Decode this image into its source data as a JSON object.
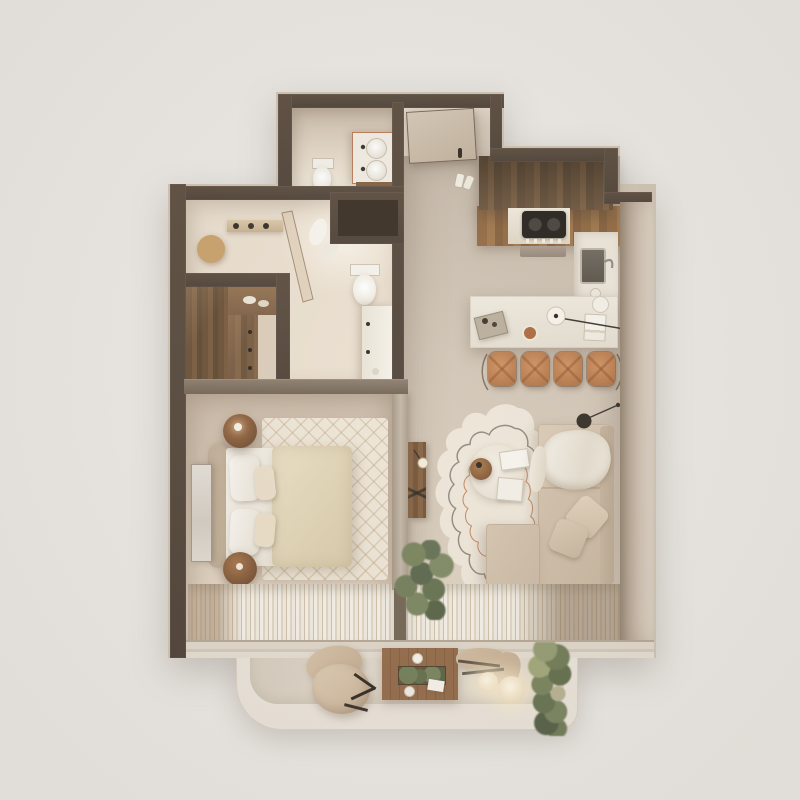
{
  "scene": {
    "type": "3d-floor-plan-render",
    "description": "Photorealistic top-down 3D render of a one-bedroom apartment with balcony, beige and walnut palette, no visible text",
    "rooms": [
      {
        "name": "entry-hall",
        "furniture": [
          "entrance-door",
          "slippers"
        ]
      },
      {
        "name": "small-bathroom",
        "furniture": [
          "double-sink-vanity",
          "toilet"
        ]
      },
      {
        "name": "main-bathroom",
        "furniture": [
          "round-gold-mirror",
          "wall-shelf",
          "glass-shower-screen",
          "towels",
          "toilet",
          "vanity-counter"
        ]
      },
      {
        "name": "walk-in-closet",
        "furniture": [
          "walnut-wardrobe",
          "drawer-unit",
          "top-shelf"
        ]
      },
      {
        "name": "technical-shaft",
        "furniture": []
      },
      {
        "name": "bedroom",
        "furniture": [
          "double-bed",
          "headboard",
          "pillows",
          "duvet",
          "round-nightstand-top",
          "round-nightstand-bottom",
          "diamond-pattern-rug",
          "leaning-framed-art",
          "wall-tv",
          "striped-curtains"
        ]
      },
      {
        "name": "kitchen",
        "furniture": [
          "walnut-upper-cabinets",
          "counter-with-gas-hob",
          "sink-counter",
          "stone-island-bar",
          "pendant-arc-lamp",
          "bar-stools",
          "serving-tray",
          "coffee-cup",
          "plate",
          "magazine"
        ]
      },
      {
        "name": "living-room",
        "furniture": [
          "l-shaped-sofa",
          "throw-blanket",
          "cushions",
          "organic-wavy-rug",
          "round-coffee-table",
          "books",
          "walnut-tray-table",
          "wall-console-shelf",
          "disc-floor-lamp",
          "reading-lamp",
          "indoor-plant",
          "striped-curtains"
        ]
      },
      {
        "name": "balcony",
        "furniture": [
          "lounge-chair",
          "wood-deck-table",
          "planter-box",
          "cups",
          "sling-chair",
          "glowing-lantern-small",
          "glowing-lantern-large",
          "tall-grass-plant"
        ]
      }
    ],
    "counts": {
      "bar_stools": 4,
      "bed_pillows": 4,
      "balcony_lanterns": 2,
      "sofa_cushions": 2,
      "bathroom_sinks": 2
    },
    "palette": {
      "bg": "#e9e6e2",
      "wall": "#493a2b",
      "wall2": "#3e3124",
      "wall-inner": "#6e5e4d",
      "wall-lightface": "#b2a18d",
      "void": "#2b1f14",
      "floor-bath": "#e8dccb",
      "floor-hall": "#c8bbab",
      "floor-living": "#ccbfae",
      "floor-bed": "#d6c5b2",
      "floor-closet": "#d8c8b4",
      "balcony": "#e8e1d7",
      "balcony-inner": "#ddd4c6",
      "wood-dark": "#5d4228",
      "wood-mid": "#8a6036",
      "counter": "#eae4d8",
      "stool": "#c07b49",
      "sofa": "#cdbaa3",
      "rug": "#ece4d6",
      "duvet": "#e1d4b6",
      "soft-white": "#f2eee5",
      "gold": "#c49a5f",
      "plant": "#66724b",
      "curtain": "#efe9df",
      "curtain-tan": "#9b8469"
    }
  }
}
